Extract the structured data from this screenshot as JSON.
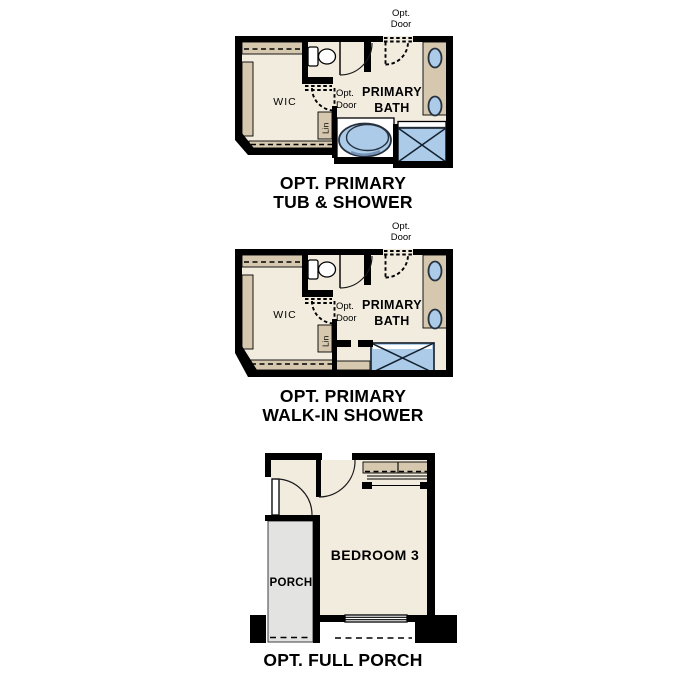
{
  "colors": {
    "floor": "#f2ecdf",
    "shelf": "#d6c8ae",
    "wall": "#000000",
    "fixture": "#abcbe9",
    "fixture_stroke": "#27323e",
    "alcove": "#ffffff",
    "porch": "#e3e3e2"
  },
  "figures": {
    "tub_shower": {
      "title_line1": "OPT. PRIMARY",
      "title_line2": "TUB & SHOWER",
      "opt_door_top_line1": "Opt.",
      "opt_door_top_line2": "Door",
      "labels": {
        "wic": "WIC",
        "opt_door_line1": "Opt.",
        "opt_door_line2": "Door",
        "bath_line1": "PRIMARY",
        "bath_line2": "BATH",
        "linen": "Lin"
      }
    },
    "walk_in_shower": {
      "title_line1": "OPT. PRIMARY",
      "title_line2": "WALK-IN SHOWER",
      "opt_door_top_line1": "Opt.",
      "opt_door_top_line2": "Door",
      "labels": {
        "wic": "WIC",
        "opt_door_line1": "Opt.",
        "opt_door_line2": "Door",
        "bath_line1": "PRIMARY",
        "bath_line2": "BATH",
        "linen": "Lin"
      }
    },
    "full_porch": {
      "title_line1": "OPT. FULL PORCH",
      "labels": {
        "porch": "PORCH",
        "bedroom": "BEDROOM 3"
      }
    }
  }
}
